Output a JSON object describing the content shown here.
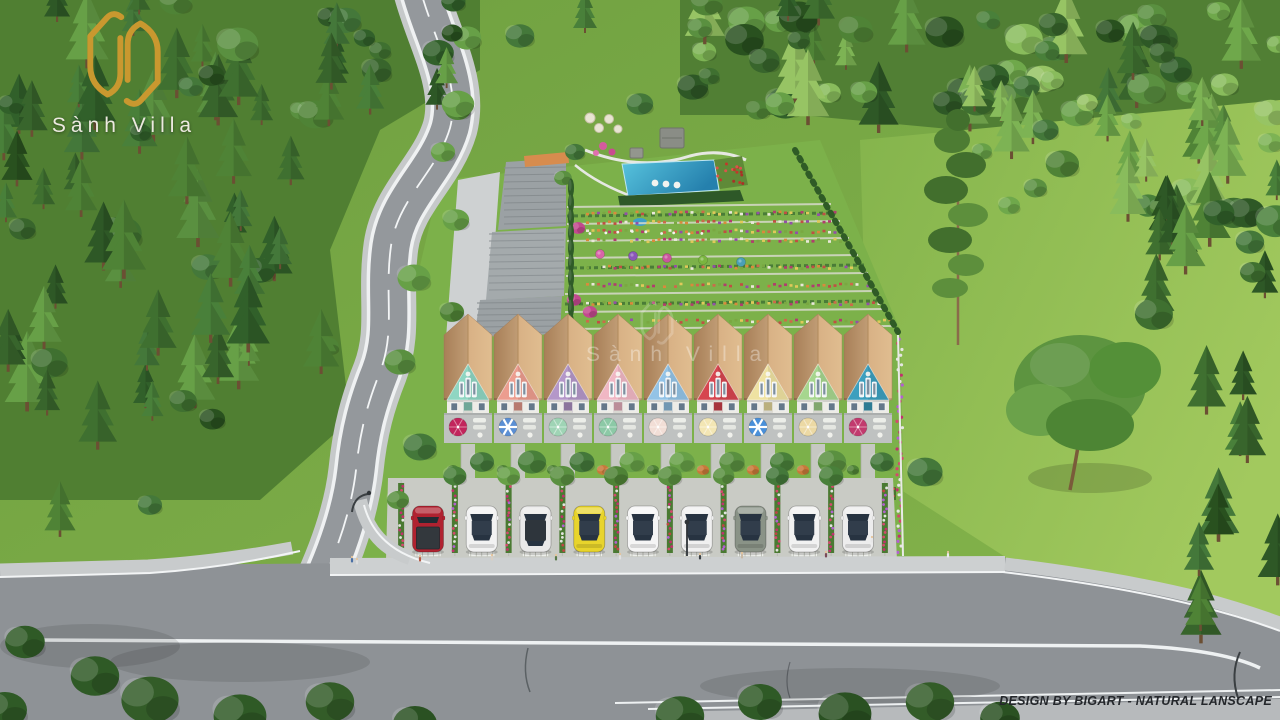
{
  "branding": {
    "logo": {
      "text": "Sành Villa",
      "emblem_color": "#c9982f"
    },
    "watermark": {
      "text": "Sành Villa"
    },
    "credit": {
      "text": "DESIGN BY BIGART - NATURAL LANSCAPE"
    }
  },
  "scene": {
    "houses": {
      "roof_color": "#cfa376",
      "units": [
        {
          "name": "lot-1",
          "facade": "#8fd6c2",
          "umbrella": "#c2255c",
          "striped": false
        },
        {
          "name": "lot-2",
          "facade": "#ec9d8f",
          "umbrella": "#5b8fd4",
          "striped": true
        },
        {
          "name": "lot-3",
          "facade": "#b497c9",
          "umbrella": "#9fd4b5",
          "striped": false
        },
        {
          "name": "lot-4",
          "facade": "#f0b7c4",
          "umbrella": "#8cc9a6",
          "striped": false
        },
        {
          "name": "lot-5",
          "facade": "#93c3e6",
          "umbrella": "#f2ded6",
          "striped": false
        },
        {
          "name": "lot-6",
          "facade": "#d6454f",
          "umbrella": "#f3e6b4",
          "striped": false
        },
        {
          "name": "lot-7",
          "facade": "#efe2a2",
          "umbrella": "#4a90d9",
          "striped": true
        },
        {
          "name": "lot-8",
          "facade": "#a6d68e",
          "umbrella": "#ecd9a4",
          "striped": false
        },
        {
          "name": "lot-9",
          "facade": "#3c9fbe",
          "umbrella": "#c23a6e",
          "striped": false
        }
      ]
    },
    "parking": {
      "cars": [
        {
          "name": "car-1",
          "body": "#b02230",
          "type": "pickup"
        },
        {
          "name": "car-2",
          "body": "#f2f2f2",
          "type": "sedan"
        },
        {
          "name": "car-3",
          "body": "#e9e9e9",
          "type": "suv"
        },
        {
          "name": "car-4",
          "body": "#e8d42c",
          "type": "sedan"
        },
        {
          "name": "car-5",
          "body": "#f5f5f5",
          "type": "sedan"
        },
        {
          "name": "car-6",
          "body": "#f0f0f0",
          "type": "sedan"
        },
        {
          "name": "car-7",
          "body": "#8a9387",
          "type": "sedan"
        },
        {
          "name": "car-8",
          "body": "#f2f2f2",
          "type": "sedan"
        },
        {
          "name": "car-9",
          "body": "#ededed",
          "type": "sedan"
        }
      ]
    },
    "amenities": {
      "pool_color": "#2f9ccb"
    }
  }
}
